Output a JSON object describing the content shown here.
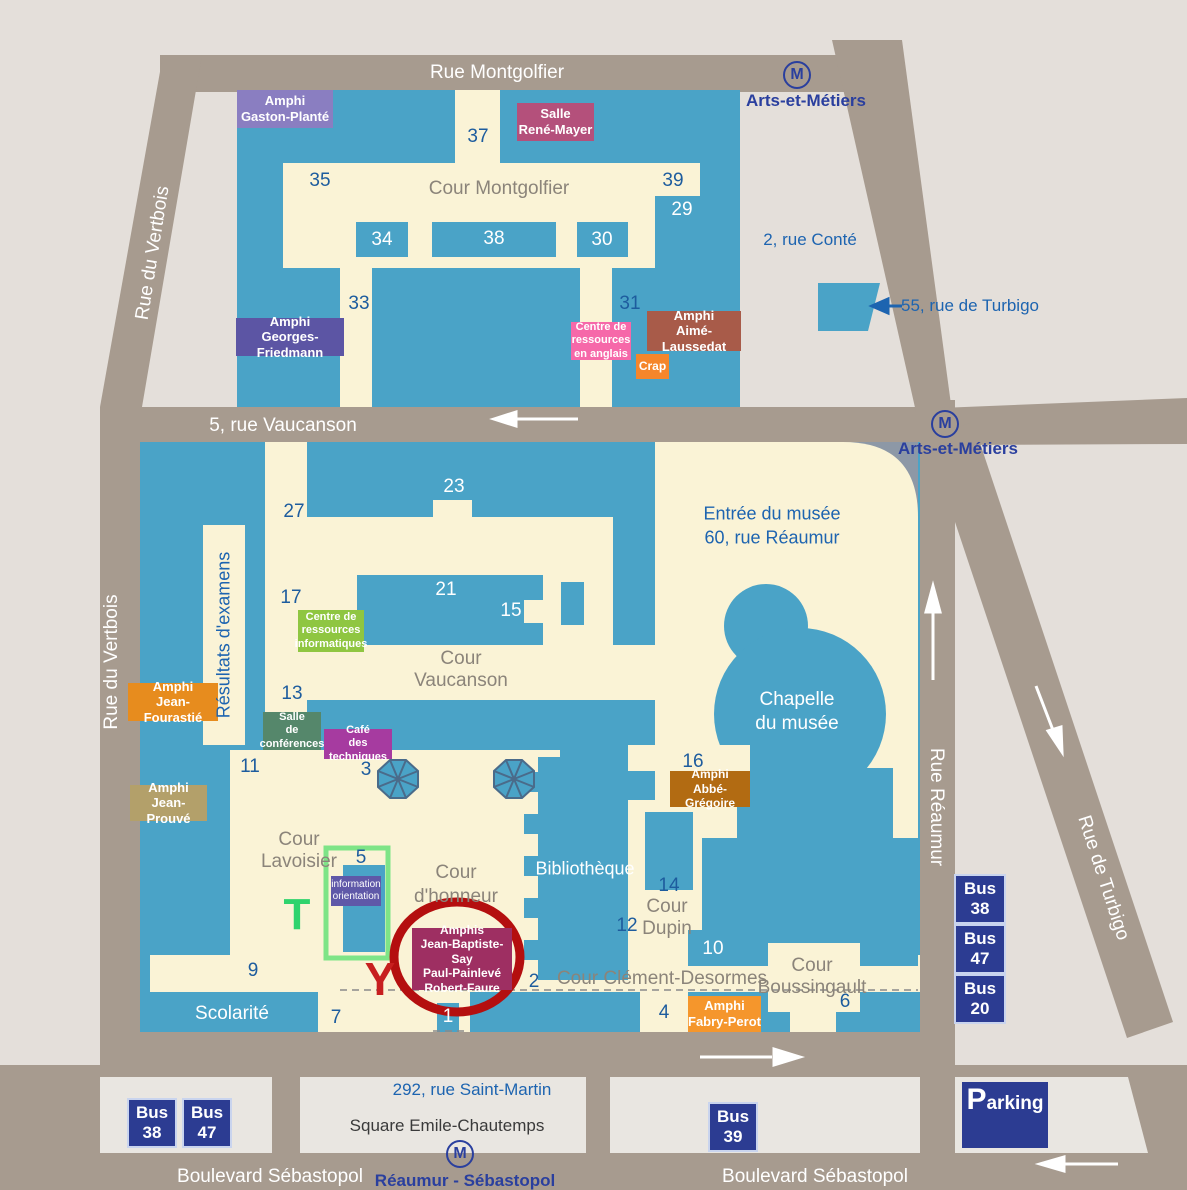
{
  "streets": {
    "rue_montgolfier": "Rue Montgolfier",
    "rue_du_vertbois_top": "Rue du Vertbois",
    "rue_du_vertbois_bottom": "Rue du Vertbois",
    "rue_vaucanson": "5, rue Vaucanson",
    "rue_reaumur": "Rue Réaumur",
    "rue_de_turbigo": "Rue de Turbigo",
    "boulevard_sebastopol_left": "Boulevard Sébastopol",
    "boulevard_sebastopol_right": "Boulevard Sébastopol"
  },
  "metro": {
    "symbol": "M",
    "m1_station": "Arts-et-Métiers",
    "m2_station": "Arts-et-Métiers",
    "m3_station": "Réaumur - Sébastopol"
  },
  "addresses": {
    "conte": "2, rue Conté",
    "turbigo55": "55, rue de Turbigo",
    "musee": [
      "Entrée du musée",
      "60, rue Réaumur"
    ],
    "saint_martin": "292, rue Saint-Martin",
    "square": "Square Emile-Chautemps"
  },
  "venues": {
    "gaston_plante": [
      "Amphi",
      "Gaston-Planté"
    ],
    "rene_mayer": [
      "Salle",
      "René-Mayer"
    ],
    "georges_friedmann": [
      "Amphi",
      "Georges-Friedmann"
    ],
    "ressources_anglais": [
      "Centre de",
      "ressources",
      "en anglais"
    ],
    "crap": "Crap",
    "aime_laussedat": [
      "Amphi",
      "Aimé-Laussedat"
    ],
    "ressources_informatiques": [
      "Centre de",
      "ressources",
      "informatiques"
    ],
    "jean_fourastie": [
      "Amphi",
      "Jean-Fourastié"
    ],
    "salle_conferences": [
      "Salle",
      "de",
      "conférences"
    ],
    "cafe_techniques": [
      "Café",
      "des techniques"
    ],
    "jean_prouve": [
      "Amphi",
      "Jean-Prouvé"
    ],
    "abbe_gregoire": [
      "Amphi",
      "Abbé-Grégoire"
    ],
    "information_orientation": [
      "information",
      "orientation"
    ],
    "amphis_say": [
      "Amphis",
      "Jean-Baptiste-Say",
      "Paul-Painlevé",
      "Robert-Faure"
    ],
    "fabry_perot": [
      "Amphi",
      "Fabry-Perot"
    ]
  },
  "courtyards": {
    "montgolfier": "Cour Montgolfier",
    "vaucanson": [
      "Cour",
      "Vaucanson"
    ],
    "lavoisier": [
      "Cour",
      "Lavoisier"
    ],
    "honneur": [
      "Cour",
      "d'honneur"
    ],
    "dupin": [
      "Cour",
      "Dupin"
    ],
    "clement_desormes": "Cour Clément-Desormes",
    "boussingault": [
      "Cour",
      "Boussingault"
    ]
  },
  "places": {
    "resultats_examens": "Résultats d'examens",
    "bibliotheque": "Bibliothèque",
    "scolarite": "Scolarité",
    "chapelle": [
      "Chapelle",
      "du musée"
    ]
  },
  "numbers": {
    "1": "1",
    "2": "2",
    "3": "3",
    "4": "4",
    "5": "5",
    "6": "6",
    "7": "7",
    "9": "9",
    "10": "10",
    "11": "11",
    "12": "12",
    "13": "13",
    "14": "14",
    "15": "15",
    "16": "16",
    "17": "17",
    "21": "21",
    "23": "23",
    "27": "27",
    "29": "29",
    "30": "30",
    "31": "31",
    "33": "33",
    "34": "34",
    "35": "35",
    "37": "37",
    "38": "38",
    "39": "39"
  },
  "bus": {
    "word": "Bus",
    "right": [
      "38",
      "47",
      "20"
    ],
    "bottom_left": [
      "38",
      "47"
    ],
    "bottom_mid": "39"
  },
  "parking": {
    "initial": "P",
    "rest": "arking"
  },
  "markers": {
    "t": "T",
    "y": "Y"
  },
  "colors": {
    "background": "#e4dfda",
    "street": "#a79b8f",
    "building_blue": "#4aa3c7",
    "courtyard_cream": "#faf3d6",
    "sidewalk": "#e9e6e1",
    "navy_badge": "#2c3c92",
    "number_blue": "#1d5c9e",
    "metro_blue": "#2a3f9e",
    "red_circle": "#b40f0f",
    "green_highlight": "#7ee487",
    "gaston_plante": "#8a7ec1",
    "rene_mayer": "#b4507b",
    "georges_friedmann": "#5c55a4",
    "ressources_anglais": "#f668a9",
    "crap": "#f5862b",
    "aime_laussedat": "#a85b49",
    "ressources_informatiques": "#8fc641",
    "jean_fourastie": "#e78c1e",
    "salle_conferences": "#55876b",
    "cafe_techniques": "#a63ba0",
    "jean_prouve": "#b3a06a",
    "abbe_gregoire": "#b26b12",
    "information_orientation": "#5f58a8",
    "amphis_say": "#9e2f62",
    "fabry_perot": "#f5962c"
  }
}
